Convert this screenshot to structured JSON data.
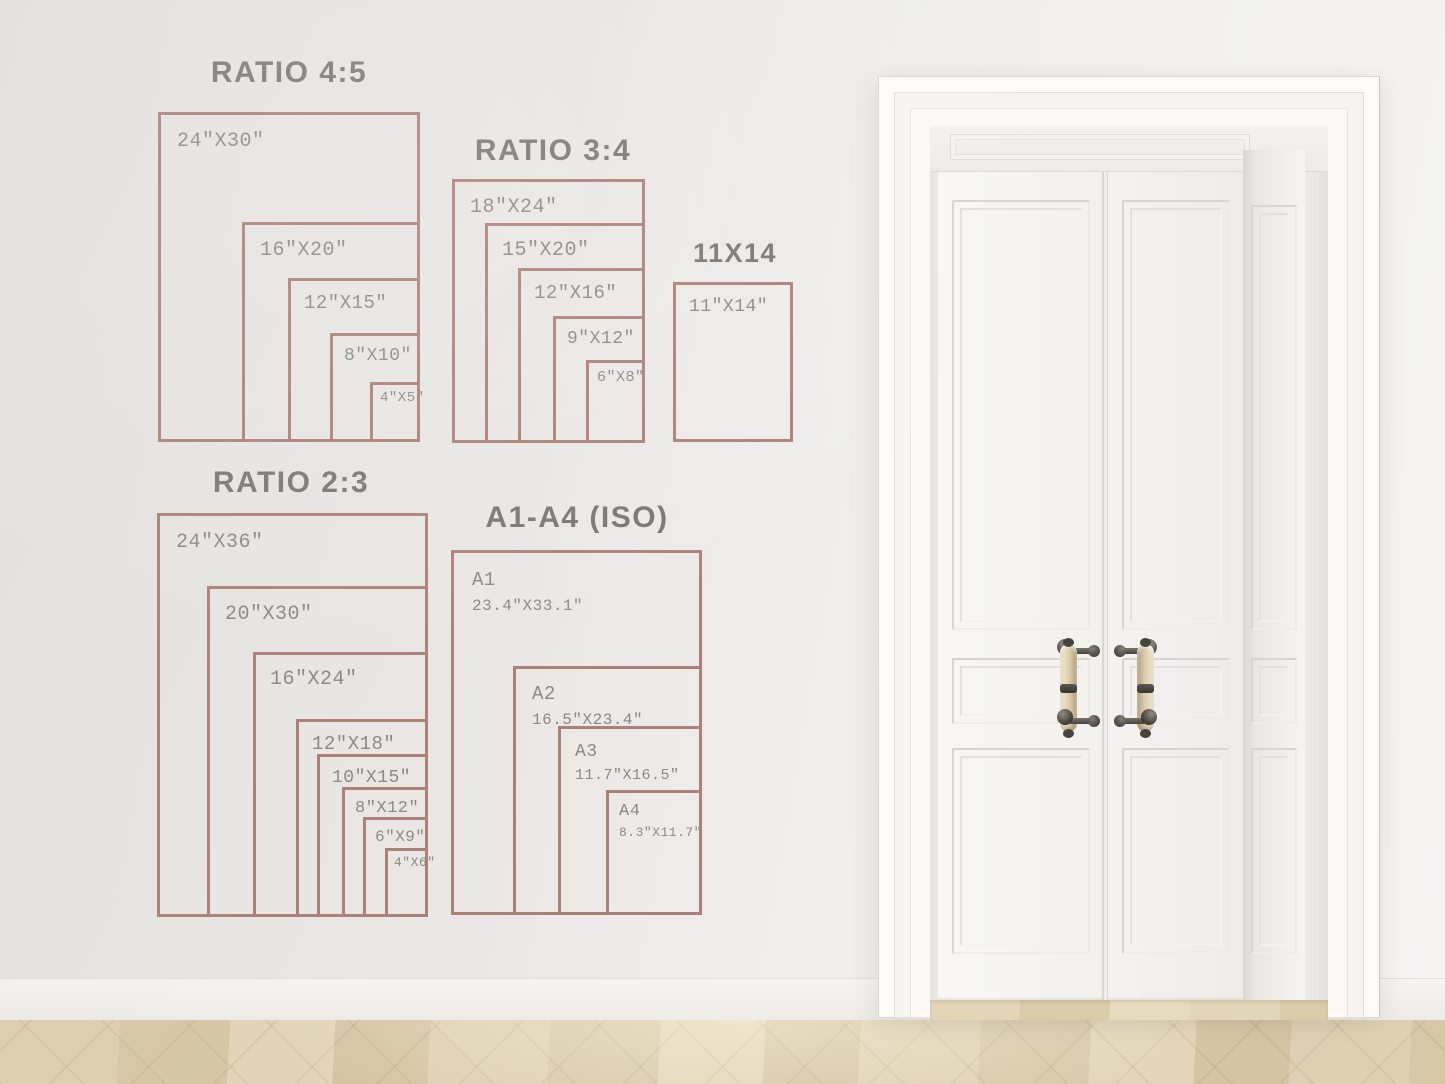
{
  "colors": {
    "accent_line": "#ad8077",
    "label_text": "#8b8884",
    "title_text": "#7b7672",
    "wall": "#ebe9e6",
    "floor_wood": "#d9c8a7",
    "door_white": "#f7f6f5",
    "handle_metal": "#47433d",
    "handle_wood": "#ddceae"
  },
  "size_guide": {
    "groups": [
      {
        "id": "ratio-4-5",
        "title": "RATIO 4:5",
        "title_cx": 289,
        "title_top": 56,
        "title_fs": 30,
        "rects": [
          {
            "label": "24\"X30\"",
            "x": 158,
            "y": 112,
            "w": 262,
            "h": 330,
            "fs": 20,
            "pad": 14
          },
          {
            "label": "16\"X20\"",
            "x": 242,
            "y": 222,
            "w": 178,
            "h": 220,
            "fs": 20,
            "pad": 13
          },
          {
            "label": "12\"X15\"",
            "x": 288,
            "y": 278,
            "w": 132,
            "h": 164,
            "fs": 19,
            "pad": 11
          },
          {
            "label": "8\"X10\"",
            "x": 330,
            "y": 333,
            "w": 90,
            "h": 109,
            "fs": 18,
            "pad": 9
          },
          {
            "label": "4\"X5\"",
            "x": 370,
            "y": 382,
            "w": 50,
            "h": 60,
            "fs": 14,
            "pad": 5
          }
        ]
      },
      {
        "id": "ratio-3-4",
        "title": "RATIO 3:4",
        "title_cx": 553,
        "title_top": 134,
        "title_fs": 30,
        "rects": [
          {
            "label": "18\"X24\"",
            "x": 452,
            "y": 179,
            "w": 193,
            "h": 264,
            "fs": 20,
            "pad": 13
          },
          {
            "label": "15\"X20\"",
            "x": 485,
            "y": 223,
            "w": 160,
            "h": 220,
            "fs": 20,
            "pad": 12
          },
          {
            "label": "12\"X16\"",
            "x": 518,
            "y": 268,
            "w": 127,
            "h": 175,
            "fs": 19,
            "pad": 11
          },
          {
            "label": "9\"X12\"",
            "x": 553,
            "y": 316,
            "w": 92,
            "h": 127,
            "fs": 18,
            "pad": 9
          },
          {
            "label": "6\"X8\"",
            "x": 586,
            "y": 360,
            "w": 59,
            "h": 83,
            "fs": 15,
            "pad": 6
          }
        ]
      },
      {
        "id": "11x14",
        "title": "11X14",
        "title_cx": 735,
        "title_top": 238,
        "title_fs": 27,
        "rects": [
          {
            "label": "11\"X14\"",
            "x": 673,
            "y": 282,
            "w": 120,
            "h": 160,
            "fs": 18,
            "pad": 11
          }
        ]
      },
      {
        "id": "ratio-2-3",
        "title": "RATIO 2:3",
        "title_cx": 291,
        "title_top": 466,
        "title_fs": 30,
        "rects": [
          {
            "label": "24\"X36\"",
            "x": 157,
            "y": 513,
            "w": 271,
            "h": 404,
            "fs": 20,
            "pad": 14
          },
          {
            "label": "20\"X30\"",
            "x": 207,
            "y": 586,
            "w": 221,
            "h": 331,
            "fs": 20,
            "pad": 13
          },
          {
            "label": "16\"X24\"",
            "x": 253,
            "y": 652,
            "w": 175,
            "h": 265,
            "fs": 20,
            "pad": 12
          },
          {
            "label": "12\"X18\"",
            "x": 296,
            "y": 719,
            "w": 132,
            "h": 198,
            "fs": 19,
            "pad": 11
          },
          {
            "label": "10\"X15\"",
            "x": 317,
            "y": 754,
            "w": 111,
            "h": 163,
            "fs": 18,
            "pad": 10
          },
          {
            "label": "8\"X12\"",
            "x": 342,
            "y": 787,
            "w": 86,
            "h": 130,
            "fs": 17,
            "pad": 8
          },
          {
            "label": "6\"X9\"",
            "x": 363,
            "y": 817,
            "w": 65,
            "h": 100,
            "fs": 16,
            "pad": 7
          },
          {
            "label": "4\"X6\"",
            "x": 385,
            "y": 848,
            "w": 43,
            "h": 69,
            "fs": 13,
            "pad": 4
          }
        ]
      },
      {
        "id": "a-series",
        "title": "A1-A4 (ISO)",
        "title_cx": 577,
        "title_top": 501,
        "title_fs": 30,
        "rects": [
          {
            "label": "A1",
            "sublabel": "23.4\"X33.1\"",
            "x": 451,
            "y": 550,
            "w": 251,
            "h": 365,
            "fs": 19,
            "sub_fs": 16,
            "pad": 16
          },
          {
            "label": "A2",
            "sublabel": "16.5\"X23.4\"",
            "x": 513,
            "y": 666,
            "w": 189,
            "h": 249,
            "fs": 19,
            "sub_fs": 16,
            "pad": 14
          },
          {
            "label": "A3",
            "sublabel": "11.7\"X16.5\"",
            "x": 558,
            "y": 726,
            "w": 144,
            "h": 189,
            "fs": 18,
            "sub_fs": 15,
            "pad": 12
          },
          {
            "label": "A4",
            "sublabel": "8.3\"X11.7\"",
            "x": 606,
            "y": 790,
            "w": 96,
            "h": 125,
            "fs": 17,
            "sub_fs": 13,
            "pad": 8
          }
        ]
      }
    ]
  }
}
